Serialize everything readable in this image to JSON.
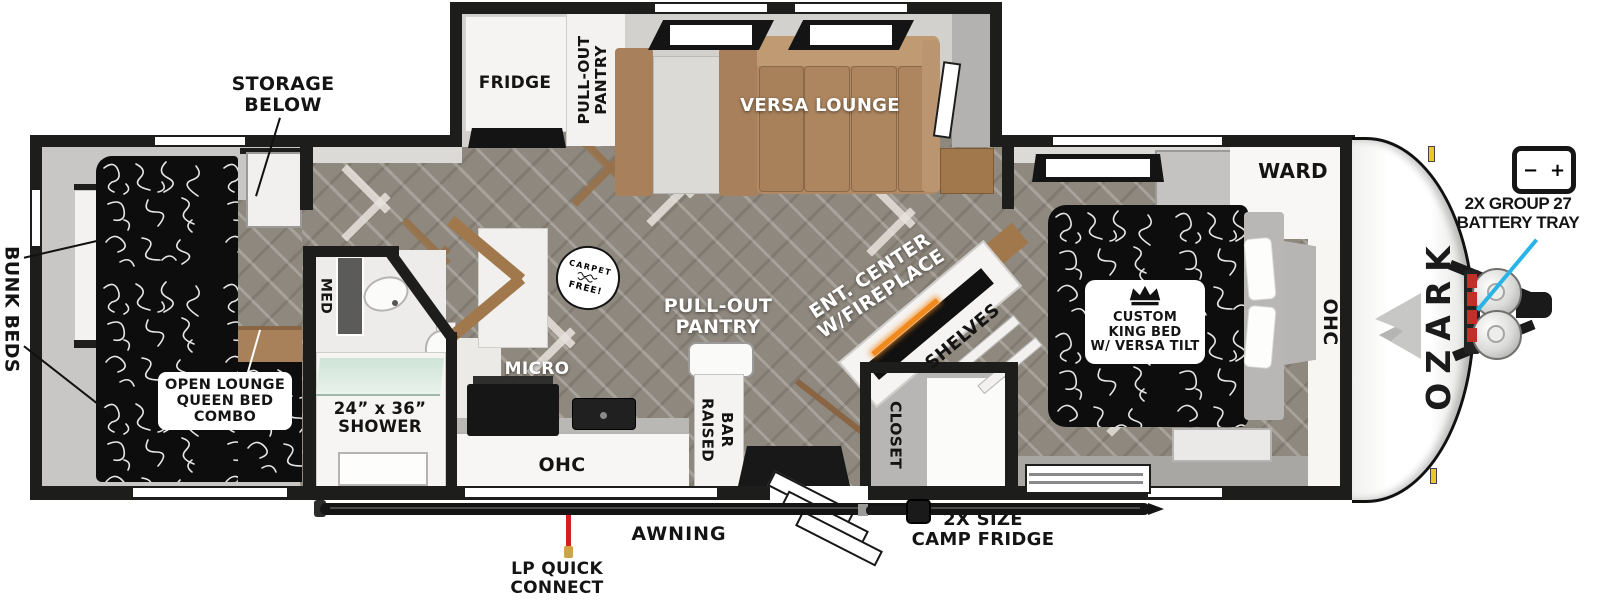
{
  "plan": {
    "brand": "OZARK",
    "type": "travel-trailer-floorplan",
    "labels": {
      "storage_below": "STORAGE\nBELOW",
      "bunk_beds": "BUNK BEDS",
      "open_lounge": "OPEN LOUNGE\nQUEEN BED\nCOMBO",
      "fridge": "FRIDGE",
      "pantry_slide": "PULL-OUT\nPANTRY",
      "versa_lounge": "VERSA LOUNGE",
      "med": "MED",
      "shower": "24” x 36”\nSHOWER",
      "micro": "MICRO",
      "ohc_kitchen": "OHC",
      "raised_bar": "RAISED\nBAR",
      "carpet_badge_top": "CARPET",
      "carpet_badge_bottom": "FREE!",
      "pantry_floor": "PULL-OUT\nPANTRY",
      "ent_center": "ENT. CENTER\nW/FIREPLACE",
      "shelves": "SHELVES",
      "closet": "CLOSET",
      "ward": "WARD",
      "ohc_bedroom": "OHC",
      "king_bed": "CUSTOM\nKING BED\nW/ VERSA TILT",
      "battery_tray": "2X GROUP 27\nBATTERY TRAY",
      "battery_minus": "−",
      "battery_plus": "+",
      "awning": "AWNING",
      "lp_quick_connect": "LP QUICK\nCONNECT",
      "camp_fridge": "2X SIZE\nCAMP FRIDGE"
    },
    "colors": {
      "wall": "#1d1d1b",
      "floor": "#8e887e",
      "couch": "#b18a63",
      "wood": "#a0784c",
      "bed_fabric": "#0d0d0d",
      "glass_teal": "#cfe4d8",
      "lp_red": "#d2201f",
      "pointer_cyan": "#29b4e6",
      "fire_orange": "#f08a1d",
      "marker_yellow": "#e8c92a"
    }
  }
}
